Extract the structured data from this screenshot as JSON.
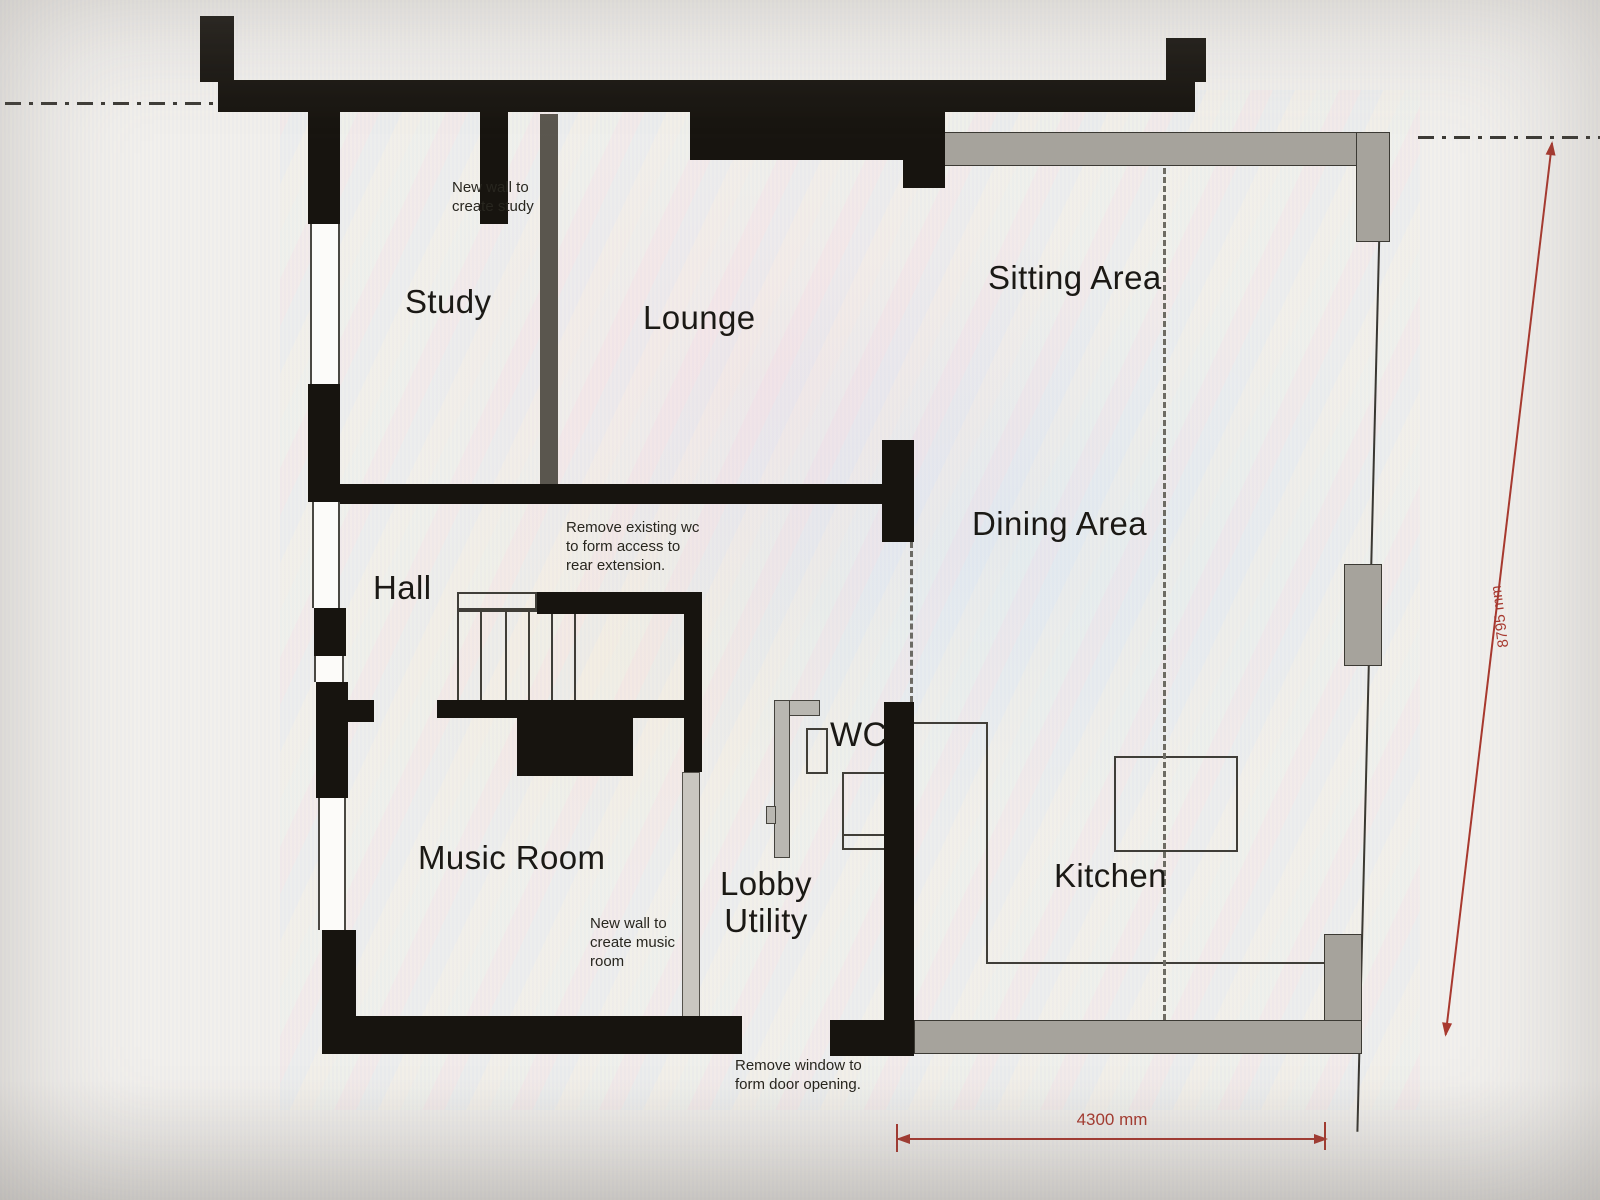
{
  "plan": {
    "type": "ground-floor-plan-photo",
    "rooms": {
      "study": "Study",
      "lounge": "Lounge",
      "sitting_area": "Sitting Area",
      "dining_area": "Dining Area",
      "hall": "Hall",
      "wc": "WC",
      "music_room": "Music Room",
      "lobby_utility": "Lobby\nUtility",
      "kitchen": "Kitchen"
    },
    "annotations": {
      "new_wall_study": "New wall to\ncreate study",
      "remove_wc": "Remove existing wc\nto form access to\nrear extension.",
      "new_wall_music": "New wall to\ncreate music\nroom",
      "remove_window": "Remove window to\nform door opening."
    },
    "dimensions": {
      "vertical": "8795 mm",
      "horizontal": "4300 mm"
    }
  },
  "colors": {
    "wall": "#17140f",
    "ext": "#a6a39c",
    "newwall": "#c9c6c0",
    "newwall_dark": "#5a564e",
    "dim": "#a8392f",
    "paper": "#f2f0ec"
  }
}
